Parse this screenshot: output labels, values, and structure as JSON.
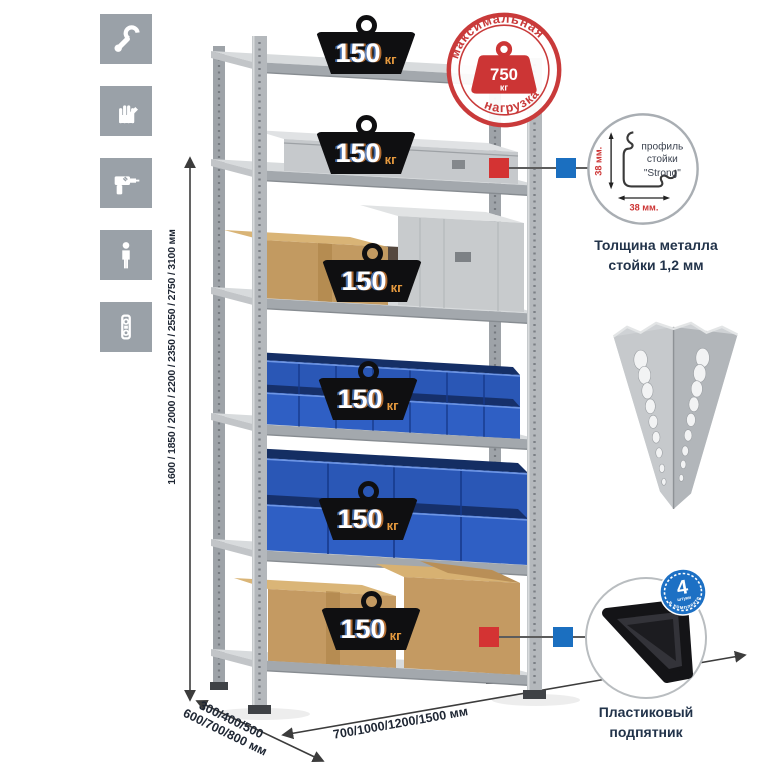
{
  "left_icons": {
    "items": [
      "wrench",
      "gloves",
      "drill",
      "person",
      "level"
    ],
    "tile_color": "#9aa1a8"
  },
  "height_dimension": {
    "label": "1600 / 1850 / 2000 / 2200 / 2350 / 2550 / 2750 / 3100 мм"
  },
  "shelf_badges": {
    "count": 6,
    "value": "150",
    "unit": "кг"
  },
  "max_load_stamp": {
    "arc_top": "максимальная",
    "arc_bottom": "нагрузка",
    "value": "750",
    "unit": "кг"
  },
  "profile_detail": {
    "text_line1": "профиль",
    "text_line2": "стойки",
    "text_line3": "\"Strong\"",
    "dim_vertical": "38 мм.",
    "dim_horizontal": "38 мм.",
    "caption_line1": "Толщина металла",
    "caption_line2": "стойки 1,2 мм"
  },
  "foot_detail": {
    "badge_value": "4",
    "badge_unit": "штуки",
    "badge_arc": "в комплекте",
    "caption_line1": "Пластиковый",
    "caption_line2": "подпятник"
  },
  "depth_dimension": {
    "line1": "300/400/500",
    "line2": "600/700/800 мм"
  },
  "width_dimension": {
    "label": "700/1000/1200/1500 мм"
  },
  "colors": {
    "accent_red": "#cb3737",
    "accent_blue": "#1b6fc0",
    "bin_blue": "#2d5cc0",
    "badge_black": "#101013",
    "text_navy": "#1d2b3a",
    "rack_gray": "#b0b4b8"
  }
}
